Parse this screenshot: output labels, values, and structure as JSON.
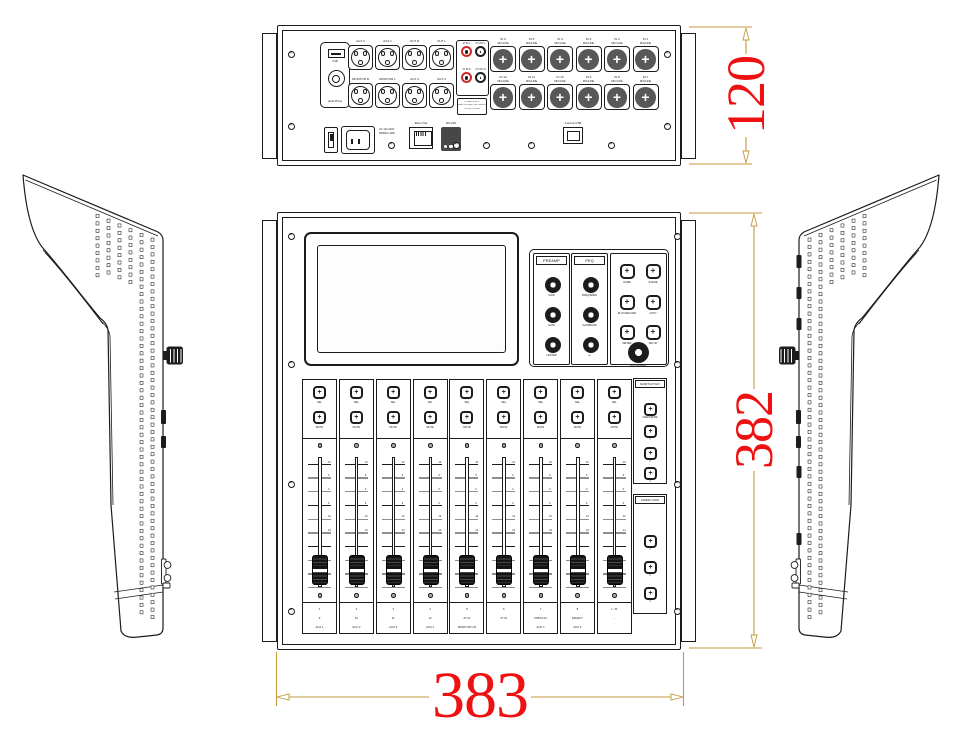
{
  "colors": {
    "line": "#1c1c1c",
    "dim_text": "#ee1111",
    "dim_line": "#c49a3c",
    "rca_red": "#cc2a2a"
  },
  "dimensions": {
    "rear_height": "120",
    "front_height": "382",
    "width": "383"
  },
  "rear_panel": {
    "usb_plate": {
      "usb_label": "USB",
      "phone_label": "Head Phone"
    },
    "output_jacks": {
      "row1": [
        "AUX 2",
        "AUX 1",
        "OUT R",
        "OUT L"
      ],
      "row2": [
        "MONITOR R",
        "MONITOR L",
        "AUX 4",
        "AUX 3"
      ]
    },
    "tape_jacks": {
      "labels": [
        "2T IN L",
        "2T OUT L",
        "2T IN R",
        "2T OUT R"
      ]
    },
    "warning_label": {
      "line1": "⚠ CAUTION ⚠",
      "line2": "RISK OF ELECTRIC SHOCK",
      "line3": "DO NOT OPEN"
    },
    "input_jacks": {
      "row1": [
        "IN 6",
        "IN 5",
        "IN 4",
        "IN 3",
        "IN 2",
        "IN 1"
      ],
      "row2": [
        "IN 12",
        "IN 11",
        "IN 10",
        "IN 9",
        "IN 8",
        "IN 7"
      ],
      "sub_label": "MIC/LINE"
    },
    "power": {
      "spec_line1": "AC 110-240V",
      "spec_line2": "50/60Hz 40W"
    },
    "ethernet_label": "Ether Net",
    "serial_label": "RS-232",
    "control_usb_label": "Control USB"
  },
  "front_panel": {
    "preamp": {
      "title": "PREAMP",
      "knobs": [
        "GAIN",
        "GATE",
        "LIMITER"
      ]
    },
    "peq": {
      "title": "PEQ",
      "knobs": [
        "FREQ/BAND",
        "GAIN/BAND",
        "Q"
      ]
    },
    "menu_buttons": [
      "HOME",
      "SCENE",
      "PLAY/RECORD",
      "COPY",
      "METER",
      "SETUP"
    ],
    "data_wheel_label": "DATA WHEEL",
    "strip_buttons": [
      "SEL",
      "MUTE"
    ],
    "fader_scale": [
      "12",
      "6",
      "0",
      "6",
      "12",
      "24"
    ],
    "channels": [
      {
        "line1": "1",
        "line2": "9",
        "line3": "AUX 1"
      },
      {
        "line1": "2",
        "line2": "10",
        "line3": "AUX 2"
      },
      {
        "line1": "3",
        "line2": "11",
        "line3": "AUX 3"
      },
      {
        "line1": "4",
        "line2": "12",
        "line3": "AUX 4"
      },
      {
        "line1": "5",
        "line2": "2T IN",
        "line3": "MONITOR L/R"
      },
      {
        "line1": "6",
        "line2": "2T IN",
        "line3": ""
      },
      {
        "line1": "7",
        "line2": "USB PLAY",
        "line3": "AUX 1"
      },
      {
        "line1": "8",
        "line2": "EFFECT",
        "line3": "AUX 2"
      },
      {
        "line1": "L / R",
        "line2": "-",
        "line3": ""
      }
    ],
    "shortcut_key": {
      "title": "SHORTCUT KEY",
      "buttons": [
        "USER DEFINE",
        "1",
        "2",
        "3"
      ]
    },
    "fader_layer": {
      "title": "FADER LAYER",
      "buttons": [
        "1",
        "2",
        "3"
      ]
    }
  }
}
